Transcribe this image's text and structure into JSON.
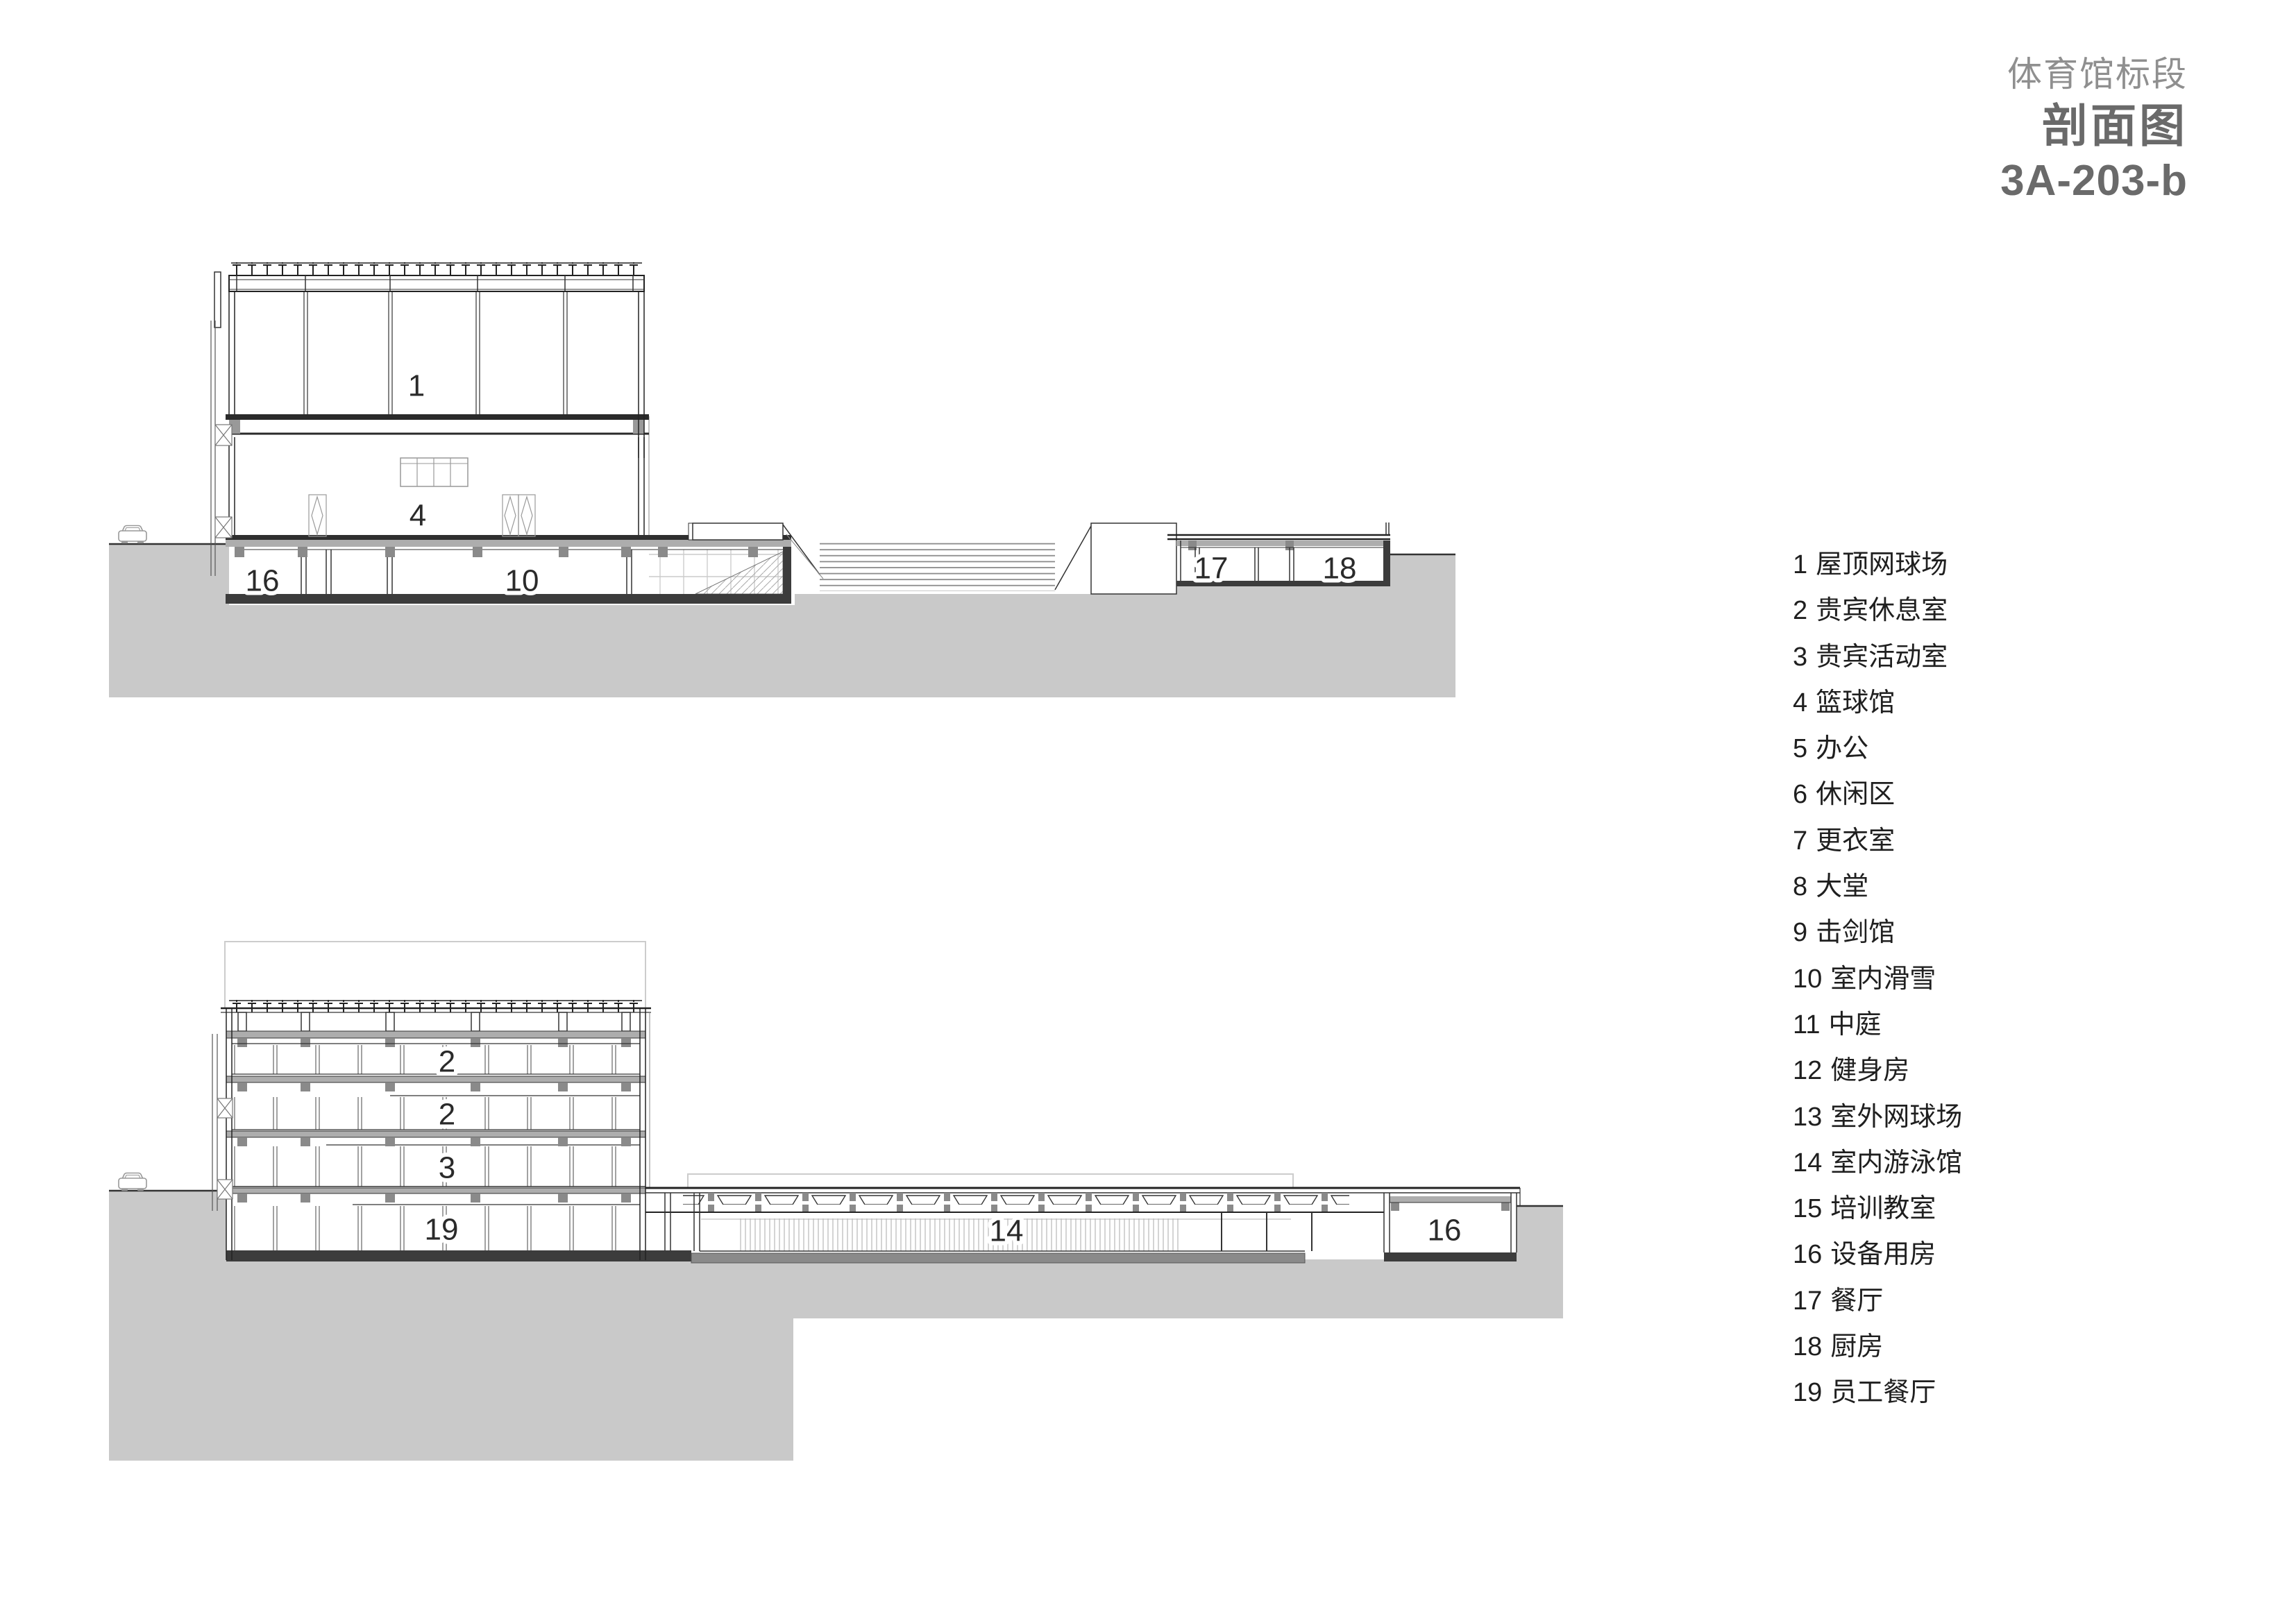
{
  "sheet": {
    "project_label": "体育馆标段",
    "drawing_title": "剖面图",
    "drawing_number": "3A-203-b"
  },
  "legend": {
    "items": [
      {
        "number": "1",
        "label": "屋顶网球场"
      },
      {
        "number": "2",
        "label": "贵宾休息室"
      },
      {
        "number": "3",
        "label": "贵宾活动室"
      },
      {
        "number": "4",
        "label": "篮球馆"
      },
      {
        "number": "5",
        "label": "办公"
      },
      {
        "number": "6",
        "label": "休闲区"
      },
      {
        "number": "7",
        "label": "更衣室"
      },
      {
        "number": "8",
        "label": "大堂"
      },
      {
        "number": "9",
        "label": "击剑馆"
      },
      {
        "number": "10",
        "label": "室内滑雪"
      },
      {
        "number": "11",
        "label": "中庭"
      },
      {
        "number": "12",
        "label": "健身房"
      },
      {
        "number": "13",
        "label": "室外网球场"
      },
      {
        "number": "14",
        "label": "室内游泳馆"
      },
      {
        "number": "15",
        "label": "培训教室"
      },
      {
        "number": "16",
        "label": "设备用房"
      },
      {
        "number": "17",
        "label": "餐厅"
      },
      {
        "number": "18",
        "label": "厨房"
      },
      {
        "number": "19",
        "label": "员工餐厅"
      }
    ]
  },
  "sections": {
    "top": {
      "rooms": [
        "1",
        "4",
        "16",
        "10",
        "17",
        "18"
      ]
    },
    "bottom": {
      "rooms": [
        "2",
        "2",
        "3",
        "19",
        "14",
        "16"
      ]
    }
  },
  "colors": {
    "ink": "#222222",
    "ground_fill": "#c9c9c9",
    "slab_dark": "#3c3c3c",
    "slab_light": "#adadad",
    "block_gray": "#8a8a8a",
    "ghost_gray": "#cccccc",
    "title_gray": "#8f8f8f",
    "title_dark": "#6a6a6a",
    "label_ink": "#2a2a2a"
  }
}
